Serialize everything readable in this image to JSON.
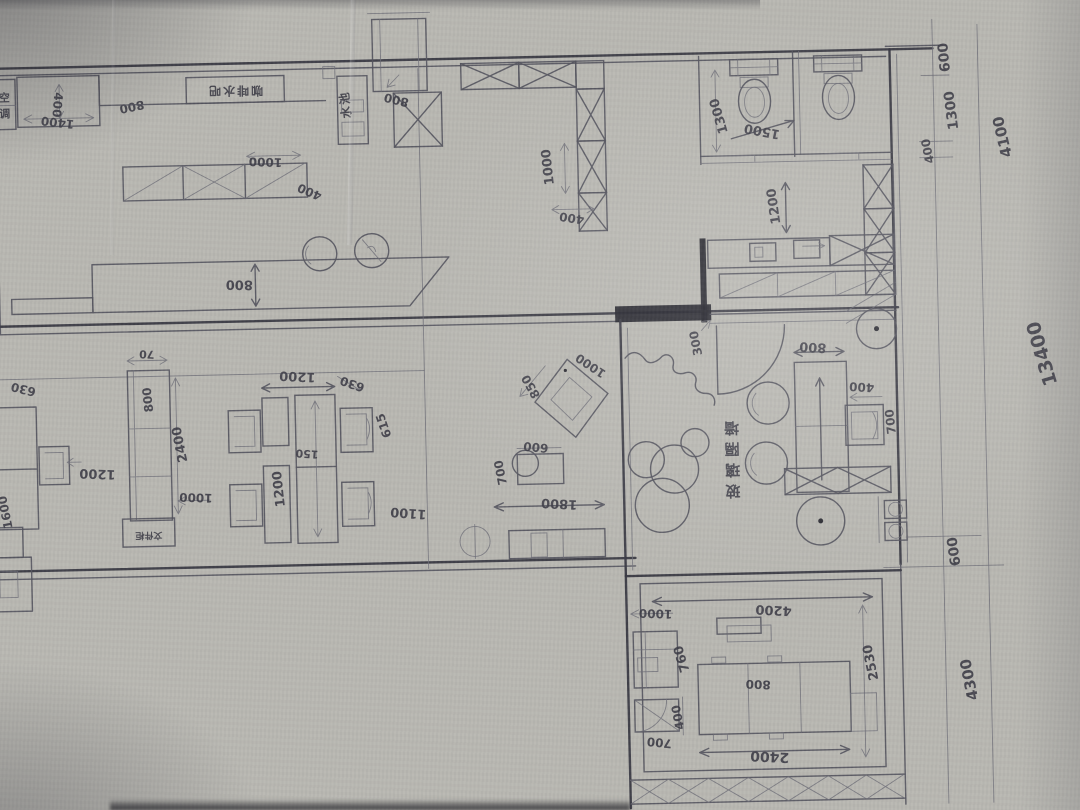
{
  "document": {
    "type": "hand-drawn floor plan sketch",
    "medium": "pencil on paper"
  },
  "tea": {
    "ac": "空调",
    "ac_chars": [
      "空",
      "调"
    ],
    "cab_len": "1400",
    "cab_dep": "400",
    "counter_dep": "800",
    "bar_label": "咖啡水吧",
    "sink": "水池",
    "col": "800",
    "shelf_len": "1000",
    "shelf_dep": "400",
    "counter2_dep": "800"
  },
  "hall": {
    "part_len": "1000",
    "part_dep": "400"
  },
  "wc": {
    "depth": "1300",
    "width": "1500",
    "lobby": "1200",
    "wall_seg": "300"
  },
  "office": {
    "cab_t": "70",
    "cab_w": "800",
    "cab_len": "2400",
    "aisle": "1000",
    "aisle_left": "1200",
    "pod_w": "1200",
    "chair": "630",
    "chair_d": "615",
    "gap": "150",
    "pod_l": "1200",
    "pod_len": "1100",
    "left_chair": "630",
    "left_desk": "1600",
    "file_label": "文件柜",
    "sq_w": "1000",
    "sq_d": "850",
    "small_w": "600",
    "small_d": "700",
    "zone_len": "1800"
  },
  "lounge": {
    "glass_label": "玻璃隔墙",
    "glass_chars": [
      "玻",
      "璃",
      "隔",
      "墙"
    ],
    "table_w": "800",
    "side_w": "400",
    "side_d": "700"
  },
  "meet": {
    "inset": "1000",
    "width": "4200",
    "cab_d": "760",
    "depth": "2530",
    "table_seg": "800",
    "seg400": "400",
    "seg700": "700",
    "table_len": "2400"
  },
  "edge": {
    "t600": "600",
    "t1300": "1300",
    "t400": "400",
    "t4100": "4100",
    "total": "13400",
    "b600": "600",
    "b4300": "4300"
  }
}
